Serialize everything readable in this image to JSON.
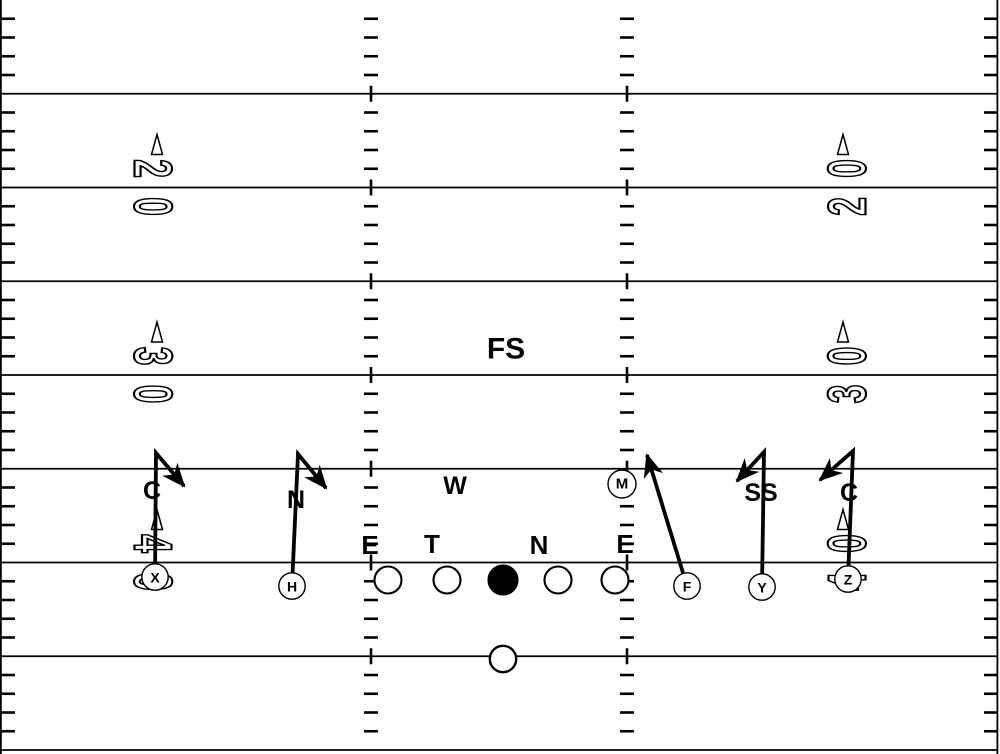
{
  "title": "Football play diagram - crack/stalk block scheme vs 4-3 defense",
  "colors": {
    "ink": "#000000",
    "bg": "#ffffff"
  },
  "field": {
    "width": 1000,
    "height": 754,
    "line_ys": [
      93.75,
      187.5,
      281.25,
      375,
      468.75,
      562.5,
      656.25,
      750
    ],
    "yard_step": 18.75,
    "sideline_ticks": [
      {
        "x1": 1,
        "x2": 15
      },
      {
        "x1": 984,
        "x2": 998
      }
    ],
    "hash_columns": [
      {
        "cx": 371
      },
      {
        "cx": 627
      }
    ],
    "hash_dash_half": 7,
    "cross_tick_half": 8,
    "border_left_x": 0.9,
    "border_right_x": 997.4
  },
  "yard_numbers": [
    {
      "text": "20",
      "side": "left",
      "x": 153,
      "line_y": 187.5
    },
    {
      "text": "20",
      "side": "right",
      "x": 847,
      "line_y": 187.5
    },
    {
      "text": "30",
      "side": "left",
      "x": 153,
      "line_y": 375
    },
    {
      "text": "30",
      "side": "right",
      "x": 847,
      "line_y": 375
    },
    {
      "text": "40",
      "side": "left",
      "x": 153,
      "line_y": 562.5
    },
    {
      "text": "40",
      "side": "right",
      "x": 847,
      "line_y": 562.5
    }
  ],
  "defense": [
    {
      "label": "FS",
      "x": 506,
      "y": 349,
      "size": 30,
      "circled": false
    },
    {
      "label": "C",
      "x": 152,
      "y": 491,
      "size": 25,
      "circled": false
    },
    {
      "label": "N",
      "x": 296,
      "y": 500,
      "size": 25,
      "circled": false
    },
    {
      "label": "W",
      "x": 455,
      "y": 486,
      "size": 25,
      "circled": false
    },
    {
      "label": "M",
      "x": 622,
      "y": 484,
      "size": 15,
      "circled": true
    },
    {
      "label": "SS",
      "x": 761,
      "y": 493,
      "size": 25,
      "circled": false
    },
    {
      "label": "C",
      "x": 849,
      "y": 493,
      "size": 25,
      "circled": false
    },
    {
      "label": "E",
      "x": 370,
      "y": 545,
      "size": 26,
      "circled": false
    },
    {
      "label": "T",
      "x": 432,
      "y": 544,
      "size": 26,
      "circled": false
    },
    {
      "label": "N",
      "x": 539,
      "y": 545,
      "size": 26,
      "circled": false
    },
    {
      "label": "E",
      "x": 625,
      "y": 544,
      "size": 26,
      "circled": false
    }
  ],
  "offense": {
    "linemen": [
      {
        "x": 388,
        "y": 580,
        "filled": false
      },
      {
        "x": 447,
        "y": 580,
        "filled": false
      },
      {
        "x": 503,
        "y": 580,
        "filled": true
      },
      {
        "x": 558,
        "y": 580,
        "filled": false
      },
      {
        "x": 615,
        "y": 580,
        "filled": false
      }
    ],
    "skill": [
      {
        "label": "X",
        "x": 155,
        "y": 577
      },
      {
        "label": "H",
        "x": 292,
        "y": 586
      },
      {
        "label": "F",
        "x": 687,
        "y": 586
      },
      {
        "label": "Y",
        "x": 762,
        "y": 587
      },
      {
        "label": "Z",
        "x": 848,
        "y": 579
      },
      {
        "label": "",
        "x": 503,
        "y": 659,
        "role": "QB"
      }
    ]
  },
  "routes": [
    {
      "player": "X",
      "points": [
        [
          155,
          577
        ],
        [
          156,
          453
        ],
        [
          184,
          486
        ]
      ]
    },
    {
      "player": "H",
      "points": [
        [
          292,
          586
        ],
        [
          298,
          454
        ],
        [
          326,
          488
        ]
      ]
    },
    {
      "player": "F",
      "points": [
        [
          687,
          586
        ],
        [
          647,
          455
        ]
      ]
    },
    {
      "player": "Y",
      "points": [
        [
          762,
          587
        ],
        [
          764,
          452
        ],
        [
          737,
          481
        ]
      ]
    },
    {
      "player": "Z",
      "points": [
        [
          848,
          579
        ],
        [
          853,
          451
        ],
        [
          820,
          480
        ]
      ]
    }
  ]
}
